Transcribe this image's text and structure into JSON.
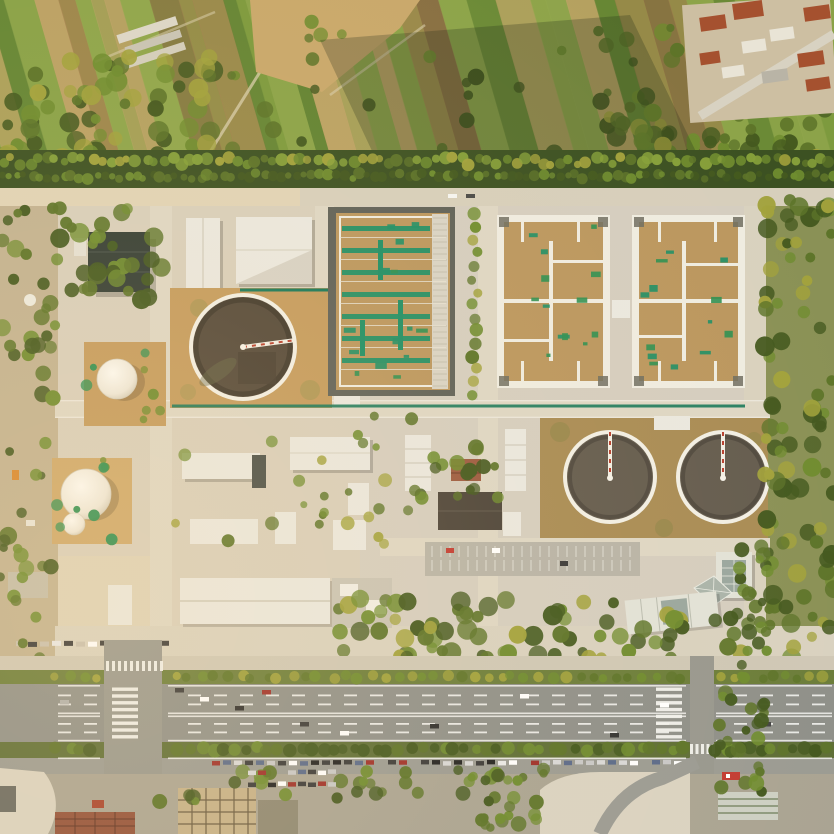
{
  "scene": {
    "type": "aerial-photograph",
    "subject": "wastewater treatment plant at golden hour",
    "regions": [
      "farmland",
      "village-rooftops",
      "tree-belt",
      "treatment-plant",
      "aeration-basin",
      "square-filtration-basins",
      "circular-clarifiers",
      "storage-domes",
      "white-roof-buildings",
      "office-complex",
      "arterial-road",
      "medians-with-trees",
      "parking-lots",
      "urban-frontage"
    ]
  },
  "palette": {
    "field_green_1": "#7d9a3e",
    "field_green_2": "#5f8031",
    "field_green_3": "#93a84e",
    "field_brown_1": "#8a6a42",
    "field_brown_2": "#a5814f",
    "field_tan": "#c0a267",
    "bare_earth": "#c9a86b",
    "tree_dark": "#44591f",
    "tree_olive": "#5d7429",
    "tree_green": "#6f8c2f",
    "tree_yellow": "#a2a23c",
    "tree_bright": "#86a03a",
    "village_red_roof": "#a5512f",
    "village_white": "#e9e4d6",
    "village_base": "#cdbfa2",
    "belt_dark": "#3c5122",
    "road_concrete": "#d7cfbc",
    "road_concrete_sun": "#ead9b2",
    "asphalt": "#8f908a",
    "asphalt_light": "#9b9b93",
    "lane_white": "#f2f2ee",
    "median_green": "#6b7d3a",
    "plant_concrete": "#d5cec0",
    "tan_pad": "#c49b5e",
    "tan_pad_dark": "#a98c55",
    "basin_tan": "#bb975f",
    "teal_pipe": "#17785a",
    "teal_walk": "#1f8f66",
    "green_patch": "#2f9052",
    "water_dark": "#53483a",
    "water_gray": "#645c4f",
    "rim_white": "#f2efe5",
    "roof_white": "#eae8e0",
    "roof_gray": "#c9c4b6",
    "roof_dark": "#333d35",
    "roof_brown_dark": "#4c443a",
    "roof_red": "#9c5a40",
    "frame_white": "#efece1",
    "basin_border": "#5f6159",
    "dome_edge": "#d4ccb8",
    "glass": "#9aa79f",
    "office_white": "#e2e2d8",
    "tile_red": "#93513a",
    "grid_tan": "#c5b189",
    "grid_line": "#6b5c43",
    "pale_lot": "#dad3c2",
    "shadow": "#1f2a16"
  },
  "generate": {
    "field_stripes": {
      "angle": -16,
      "cx": 400,
      "cy": 100,
      "x0": -220,
      "x1": 1060,
      "wmin": 9,
      "wmax": 34,
      "y": -140,
      "h": 430,
      "colors": [
        "field_green_1",
        "field_brown_1",
        "field_green_2",
        "field_tan",
        "field_green_3",
        "field_brown_2"
      ]
    },
    "tree_bands": [
      {
        "layer": "g-farm-trees",
        "name": "farm-left-trees",
        "type": "scatter",
        "x0": 0,
        "x1": 220,
        "y0": 55,
        "y1": 168,
        "n": 70,
        "rmin": 5,
        "rmax": 11,
        "colors": [
          "tree_dark",
          "tree_olive",
          "tree_green",
          "tree_yellow"
        ]
      },
      {
        "layer": "g-farm-trees",
        "name": "farm-scatter",
        "type": "scatter",
        "x0": 215,
        "x1": 700,
        "y0": 15,
        "y1": 158,
        "n": 38,
        "rmin": 4,
        "rmax": 9,
        "colors": [
          "tree_olive",
          "tree_green",
          "tree_dark"
        ]
      },
      {
        "layer": "g-farm-trees",
        "name": "farm-right-trees",
        "type": "scatter",
        "x0": 600,
        "x1": 834,
        "y0": 95,
        "y1": 175,
        "n": 55,
        "rmin": 5,
        "rmax": 10,
        "colors": [
          "tree_dark",
          "tree_olive",
          "tree_yellow",
          "tree_green"
        ]
      },
      {
        "layer": "g-belt-trees",
        "name": "belt-row-a",
        "type": "row",
        "x0": 2,
        "x1": 832,
        "y": 161,
        "step": 9,
        "jit": 4,
        "rmin": 3.5,
        "rmax": 6.5,
        "colors": [
          "tree_green",
          "tree_yellow",
          "tree_olive",
          "tree_bright"
        ]
      },
      {
        "layer": "g-belt-trees",
        "name": "belt-row-b",
        "type": "row",
        "x0": 0,
        "x1": 834,
        "y": 176,
        "step": 8,
        "jit": 3,
        "rmin": 3,
        "rmax": 6,
        "colors": [
          "tree_dark",
          "tree_olive",
          "tree_green"
        ]
      },
      {
        "layer": "g-plant-trees",
        "name": "plant-right-margin",
        "type": "scatter",
        "x0": 764,
        "x1": 834,
        "y0": 200,
        "y1": 665,
        "n": 85,
        "rmin": 5,
        "rmax": 10,
        "colors": [
          "tree_olive",
          "tree_dark",
          "tree_green",
          "tree_yellow"
        ]
      },
      {
        "layer": "g-plant-trees",
        "name": "plant-left-margin",
        "type": "scatter",
        "x0": 0,
        "x1": 58,
        "y0": 205,
        "y1": 665,
        "n": 46,
        "rmin": 4,
        "rmax": 9,
        "colors": [
          "tree_olive",
          "tree_green",
          "tree_dark"
        ]
      },
      {
        "layer": "g-plant-trees",
        "name": "nw-grove",
        "type": "scatter",
        "x0": 58,
        "x1": 168,
        "y0": 208,
        "y1": 302,
        "n": 30,
        "rmin": 5,
        "rmax": 10,
        "colors": [
          "tree_dark",
          "tree_olive",
          "tree_green"
        ]
      },
      {
        "layer": "g-plant-trees",
        "name": "basin-west-tree-row",
        "type": "vrow",
        "x": 474,
        "y0": 214,
        "y1": 402,
        "step": 13,
        "jit": 4,
        "rmin": 4,
        "rmax": 7,
        "colors": [
          "tree_green",
          "tree_olive",
          "tree_yellow"
        ]
      },
      {
        "layer": "g-plant-trees",
        "name": "mid-cluster",
        "type": "scatter",
        "x0": 420,
        "x1": 505,
        "y0": 432,
        "y1": 500,
        "n": 16,
        "rmin": 4,
        "rmax": 8,
        "colors": [
          "tree_green",
          "tree_olive",
          "tree_dark"
        ]
      },
      {
        "layer": "g-plant-trees",
        "name": "mid-scatter",
        "type": "scatter",
        "x0": 165,
        "x1": 420,
        "y0": 415,
        "y1": 556,
        "n": 26,
        "rmin": 3.5,
        "rmax": 7,
        "colors": [
          "tree_olive",
          "tree_green",
          "tree_yellow"
        ]
      },
      {
        "layer": "g-plant-trees",
        "name": "dome-grass-1",
        "type": "scatter",
        "x0": 86,
        "x1": 164,
        "y0": 344,
        "y1": 424,
        "n": 8,
        "rmin": 3,
        "rmax": 6,
        "colors": [
          "tree_green",
          "green_patch"
        ]
      },
      {
        "layer": "g-plant-trees",
        "name": "dome-grass-2",
        "type": "scatter",
        "x0": 56,
        "x1": 130,
        "y0": 460,
        "y1": 542,
        "n": 8,
        "rmin": 3,
        "rmax": 6,
        "colors": [
          "tree_green",
          "green_patch"
        ]
      },
      {
        "layer": "g-plant-trees",
        "name": "south-band",
        "type": "scatter",
        "x0": 335,
        "x1": 765,
        "y0": 596,
        "y1": 658,
        "n": 75,
        "rmin": 5,
        "rmax": 10,
        "colors": [
          "tree_olive",
          "tree_green",
          "tree_dark",
          "tree_yellow"
        ]
      },
      {
        "layer": "g-road-trees",
        "name": "median-north",
        "type": "row",
        "x0": 58,
        "x1": 832,
        "y": 677,
        "step": 13,
        "jit": 2,
        "rmin": 4,
        "rmax": 6,
        "colors": [
          "tree_green",
          "tree_olive",
          "tree_yellow"
        ],
        "skip": [
          [
            100,
            168
          ],
          [
            686,
            716
          ]
        ]
      },
      {
        "layer": "g-road-trees",
        "name": "median-south",
        "type": "row",
        "x0": 58,
        "x1": 832,
        "y": 749,
        "step": 11,
        "jit": 2,
        "rmin": 4.5,
        "rmax": 7,
        "colors": [
          "tree_dark",
          "tree_olive",
          "tree_green"
        ],
        "skip": [
          [
            100,
            168
          ],
          [
            686,
            716
          ]
        ]
      },
      {
        "layer": "g-bottom-trees",
        "name": "bottom-row",
        "type": "scatter",
        "x0": 140,
        "x1": 540,
        "y0": 770,
        "y1": 802,
        "n": 34,
        "rmin": 4,
        "rmax": 8,
        "colors": [
          "tree_dark",
          "tree_olive",
          "tree_green"
        ]
      },
      {
        "layer": "g-bottom-trees",
        "name": "se-office-trees",
        "type": "scatter",
        "x0": 735,
        "x1": 772,
        "y0": 540,
        "y1": 648,
        "n": 24,
        "rmin": 4,
        "rmax": 8,
        "colors": [
          "tree_dark",
          "tree_olive",
          "tree_green"
        ]
      },
      {
        "layer": "g-bottom-trees",
        "name": "right-street-green",
        "type": "scatter",
        "x0": 714,
        "x1": 766,
        "y0": 658,
        "y1": 800,
        "n": 26,
        "rmin": 4,
        "rmax": 8,
        "colors": [
          "tree_olive",
          "tree_green",
          "tree_dark"
        ]
      },
      {
        "layer": "g-bottom-trees",
        "name": "bottom-center-green",
        "type": "scatter",
        "x0": 470,
        "x1": 545,
        "y0": 765,
        "y1": 830,
        "n": 18,
        "rmin": 4,
        "rmax": 8,
        "colors": [
          "tree_olive",
          "tree_green"
        ]
      }
    ],
    "green_patches": [
      {
        "layer": "g-basin-patches",
        "x": 342,
        "y": 218,
        "w": 88,
        "h": 166,
        "n": 14
      },
      {
        "layer": "g-basin-patches",
        "x": 505,
        "y": 224,
        "w": 98,
        "h": 156,
        "n": 13
      },
      {
        "layer": "g-basin-patches",
        "x": 640,
        "y": 224,
        "w": 98,
        "h": 156,
        "n": 13
      }
    ],
    "lane_marks": {
      "dash_ys": [
        694.5,
        703.5,
        723,
        731.5
      ],
      "solid_ys": [
        685,
        739.8,
        757.5
      ],
      "center_ys": [
        712.5,
        715.5
      ],
      "x0": 58,
      "x1": 832,
      "dash": 13,
      "gap": 13,
      "skip": [
        [
          100,
          168
        ],
        [
          686,
          716
        ]
      ]
    },
    "zebras": [
      {
        "kind": "ladder",
        "x": 112,
        "barW": 26,
        "y0": 687.5,
        "y1": 738,
        "step": 6.8,
        "barH": 3.4
      },
      {
        "kind": "ladder",
        "x": 656,
        "barW": 26,
        "y0": 687.5,
        "y1": 738,
        "step": 6.8,
        "barH": 3.4
      },
      {
        "kind": "crossbar",
        "y": 661,
        "barH": 10,
        "x0": 106,
        "x1": 160,
        "step": 6,
        "barW": 3
      },
      {
        "kind": "crossbar",
        "y": 744,
        "barH": 10,
        "x0": 690,
        "x1": 712,
        "step": 5.5,
        "barW": 3
      }
    ],
    "parked_rows": [
      {
        "layer": "g-road-cars",
        "y": 760.5,
        "x0": 212,
        "x1": 688,
        "step": 11,
        "w": 8,
        "h": 4.5,
        "skip": [
          [
            686,
            716
          ]
        ]
      },
      {
        "layer": "g-bottom-cars",
        "y": 770,
        "x0": 248,
        "x1": 332,
        "step": 10,
        "w": 8,
        "h": 4.5
      },
      {
        "layer": "g-bottom-cars",
        "y": 782,
        "x0": 248,
        "x1": 332,
        "step": 10,
        "w": 8,
        "h": 4.5
      }
    ],
    "truck_row": {
      "y": 641,
      "x0": 16,
      "x1": 168,
      "step": 12,
      "w": 9,
      "h": 5
    },
    "parking_stalls": {
      "x0": 432,
      "x1": 630,
      "rows": [
        546,
        560
      ],
      "h": 11,
      "step": 9
    },
    "car_colors": [
      "#ffffff",
      "#d8d8d8",
      "#3a3a3a",
      "#9e2f2a",
      "#5a6a8a",
      "#c8c8c8",
      "#222222",
      "#e8e8e8"
    ]
  }
}
